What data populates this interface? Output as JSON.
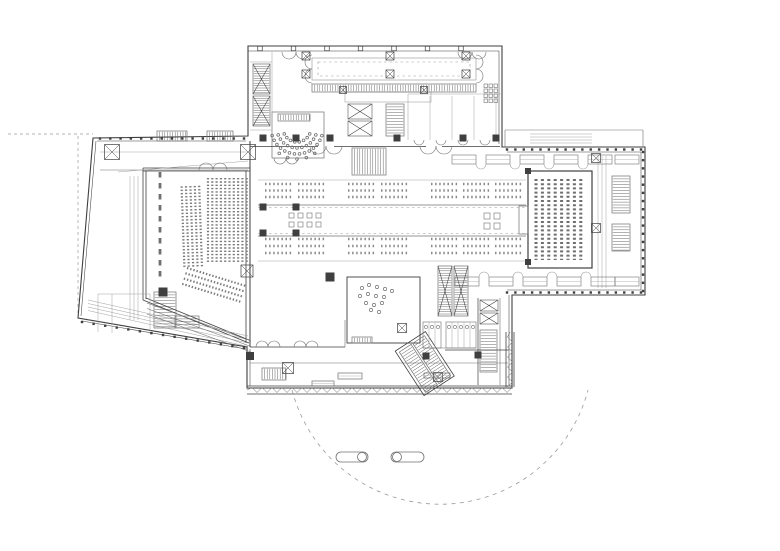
{
  "meta": {
    "title": "architectural-floor-plan",
    "description": "line-drawing building plan: auditorium, amphitheater, foyer with reading tables, book-stack hall, service cores, entrance plaza circle",
    "paper": "#ffffff"
  },
  "colors": {
    "ink": "#3f3f3f",
    "mid": "#707070",
    "light": "#a2a2a2",
    "hatch": "#565656",
    "dash": "#9a9a9a",
    "table": "#8b8b8b"
  },
  "rooms": [
    "auditorium",
    "amphitheater",
    "foyer-reading-tables",
    "book-stack-hall",
    "stair-cores",
    "escalators",
    "elevators",
    "restrooms",
    "shop-room",
    "south-gallery",
    "entrance-plaza"
  ],
  "gen": {
    "tables": {
      "bands": [
        {
          "rows": [
            184,
            190.5,
            197
          ]
        },
        {
          "rows": [
            239,
            246,
            253
          ]
        }
      ],
      "groups": [
        [
          265,
          293
        ],
        [
          298,
          326
        ],
        [
          348,
          376
        ],
        [
          381,
          409
        ],
        [
          431,
          459
        ],
        [
          463,
          491
        ],
        [
          495,
          523
        ]
      ],
      "dash": "1.5 2.6",
      "width": 2.4
    },
    "seatBlocks": [
      {
        "x0": 208,
        "step": 4.3,
        "count": 10,
        "y0": 178,
        "y1": 263,
        "tf": ""
      },
      {
        "x0": 183,
        "step": 4.4,
        "count": 5,
        "y0": 186,
        "y1": 268,
        "tf": "rotate(-2 193 227)"
      }
    ],
    "slantSeats": {
      "x": 187,
      "y": 268,
      "rows": 4,
      "gap": 5.3,
      "len": 62,
      "angle": 17
    },
    "stacks": {
      "x0": 536,
      "step": 6.4,
      "count": 8,
      "y0": 179,
      "y1": 260,
      "w": 3,
      "dash": "2 2.2"
    },
    "fan": {
      "cx": 297,
      "cy": 128,
      "rings": [
        {
          "r": 14,
          "a0": 25,
          "a1": 155,
          "n": 8
        },
        {
          "r": 20,
          "a0": 20,
          "a1": 160,
          "n": 11
        },
        {
          "r": 26,
          "a0": 17,
          "a1": 163,
          "n": 14
        },
        {
          "r": 31,
          "a0": 55,
          "a1": 125,
          "n": 5
        }
      ]
    },
    "mullions": [
      {
        "x1": 507,
        "y1": 149.5,
        "x2": 641,
        "y2": 149.5,
        "sp": 8
      },
      {
        "x1": 643,
        "y1": 152,
        "x2": 643,
        "y2": 291,
        "sp": 8
      },
      {
        "x1": 507,
        "y1": 292.5,
        "x2": 641,
        "y2": 292.5,
        "sp": 8
      },
      {
        "x1": 100,
        "y1": 138.5,
        "x2": 244,
        "y2": 138.5,
        "sp": 10
      },
      {
        "x1": 82,
        "y1": 322,
        "x2": 244,
        "y2": 348,
        "sp": 11
      }
    ],
    "topTicks": {
      "y": 48.5,
      "x0": 260,
      "x1": 494,
      "sp": 33.5,
      "s": 4.5
    },
    "zigzags": [
      {
        "x1": 247,
        "y1": 390,
        "x2": 512,
        "y2": 390,
        "amp": 2.5,
        "per": 5,
        "o": "h"
      },
      {
        "x1": 510,
        "y1": 332,
        "x2": 510,
        "y2": 387,
        "amp": 2.5,
        "per": 5,
        "o": "v"
      }
    ],
    "hatches": [
      [
        253,
        64,
        17,
        30,
        "esc"
      ],
      [
        253,
        96,
        17,
        30,
        "esc"
      ],
      [
        278,
        114,
        32,
        7,
        "v"
      ],
      [
        157,
        131,
        30,
        10,
        "v"
      ],
      [
        207,
        131,
        26,
        10,
        "v"
      ],
      [
        312,
        84,
        164,
        8,
        "v"
      ],
      [
        348,
        104,
        24,
        15,
        "x"
      ],
      [
        348,
        121,
        24,
        15,
        "x"
      ],
      [
        386,
        104,
        18,
        32,
        "h"
      ],
      [
        352,
        148,
        34,
        27,
        "v"
      ],
      [
        438,
        266,
        14,
        50,
        "esc"
      ],
      [
        454,
        266,
        14,
        50,
        "esc"
      ],
      [
        612,
        176,
        18,
        37,
        "h"
      ],
      [
        612,
        224,
        18,
        27,
        "h"
      ],
      [
        480,
        330,
        17,
        42,
        "h"
      ],
      [
        480,
        300,
        18,
        11,
        "x"
      ],
      [
        480,
        313,
        18,
        11,
        "x"
      ],
      [
        154,
        292,
        22,
        36,
        "h"
      ],
      [
        262,
        368,
        24,
        12,
        "v"
      ],
      [
        352,
        337,
        20,
        6,
        "v"
      ],
      [
        175,
        316,
        24,
        12,
        "h"
      ]
    ],
    "rotHatch": {
      "tf": "rotate(-33 425 364)",
      "outline": [
        407,
        337,
        36,
        53
      ],
      "rects": [
        [
          410,
          340,
          14,
          48
        ],
        [
          426,
          340,
          14,
          48
        ]
      ]
    },
    "restrooms": [
      {
        "x": 423,
        "y": 322,
        "w": 18,
        "h": 26,
        "n": 3
      },
      {
        "x": 446,
        "y": 322,
        "w": 30,
        "h": 26,
        "n": 5
      }
    ],
    "casework": [
      {
        "y": 155,
        "h": 9,
        "w": 24,
        "xs": [
          452,
          486,
          520,
          554,
          588,
          615
        ],
        "bulge": "down"
      },
      {
        "y": 277,
        "h": 9,
        "w": 24,
        "xs": [
          455,
          489,
          523,
          557,
          591,
          615
        ],
        "bulge": "up"
      }
    ],
    "doors": [
      [
        289,
        52,
        7,
        0
      ],
      [
        303,
        52,
        7,
        0
      ],
      [
        465,
        52,
        7,
        0
      ],
      [
        479,
        52,
        7,
        0
      ],
      [
        318,
        146,
        8,
        0
      ],
      [
        334,
        146,
        8,
        0
      ],
      [
        428,
        146,
        8,
        0
      ],
      [
        444,
        146,
        8,
        0
      ],
      [
        206,
        170,
        7,
        1
      ],
      [
        220,
        170,
        7,
        1
      ],
      [
        280,
        158,
        6,
        0
      ],
      [
        292,
        158,
        6,
        0
      ],
      [
        262,
        347,
        6,
        1
      ],
      [
        274,
        347,
        6,
        1
      ],
      [
        300,
        347,
        6,
        1
      ],
      [
        312,
        347,
        6,
        1
      ],
      [
        419,
        140,
        5,
        0
      ],
      [
        441,
        140,
        5,
        0
      ],
      [
        463,
        140,
        5,
        0
      ],
      [
        485,
        140,
        5,
        0
      ]
    ],
    "vdoors": [
      [
        312,
        62,
        7,
        0
      ],
      [
        312,
        76,
        7,
        0
      ],
      [
        476,
        62,
        7,
        1
      ],
      [
        476,
        76,
        7,
        1
      ]
    ],
    "columns": [
      [
        263,
        138,
        7
      ],
      [
        296,
        138,
        7
      ],
      [
        330,
        138,
        7
      ],
      [
        397,
        138,
        7
      ],
      [
        463,
        138,
        7
      ],
      [
        496,
        138,
        7
      ],
      [
        263,
        207,
        7
      ],
      [
        296,
        207,
        7
      ],
      [
        263,
        233,
        7
      ],
      [
        296,
        233,
        7
      ],
      [
        330,
        277,
        9
      ],
      [
        250,
        356,
        8
      ],
      [
        426,
        356,
        7
      ],
      [
        478,
        355,
        7
      ],
      [
        163,
        292,
        9
      ],
      [
        528,
        171,
        6
      ],
      [
        528,
        262,
        6
      ]
    ],
    "xsquares": [
      [
        112,
        152,
        15
      ],
      [
        248,
        152,
        15
      ],
      [
        247,
        271,
        12
      ],
      [
        288,
        368,
        11
      ],
      [
        306,
        56,
        8
      ],
      [
        390,
        56,
        8
      ],
      [
        466,
        56,
        8
      ],
      [
        306,
        74,
        8
      ],
      [
        390,
        74,
        8
      ],
      [
        466,
        74,
        8
      ],
      [
        343,
        90,
        7
      ],
      [
        424,
        90,
        7
      ],
      [
        402,
        328,
        9
      ],
      [
        438,
        377,
        9
      ],
      [
        596,
        158,
        9
      ],
      [
        596,
        228,
        9
      ]
    ],
    "sqClusters": [
      {
        "x": 289,
        "y": 213,
        "cols": 4,
        "rows": 2,
        "s": 5,
        "gap": 9
      },
      {
        "x": 484,
        "y": 213,
        "cols": 2,
        "rows": 2,
        "s": 6,
        "gap": 10
      }
    ],
    "grids": [
      {
        "x": 484,
        "y": 84,
        "cols": 3,
        "rows": 4,
        "s": 3.5,
        "gap": 1.5
      }
    ],
    "shopDots": [
      [
        362,
        288
      ],
      [
        369,
        285
      ],
      [
        377,
        287
      ],
      [
        385,
        289
      ],
      [
        392,
        291
      ],
      [
        360,
        296
      ],
      [
        368,
        294
      ],
      [
        376,
        296
      ],
      [
        384,
        297
      ],
      [
        366,
        303
      ],
      [
        374,
        305
      ],
      [
        382,
        303
      ],
      [
        371,
        310
      ],
      [
        379,
        312
      ]
    ],
    "benches": [
      [
        312,
        381,
        22,
        5
      ],
      [
        338,
        373,
        24,
        6
      ],
      [
        424,
        373,
        26,
        5
      ]
    ],
    "pills": [
      {
        "x": 336,
        "y": 452,
        "w": 32,
        "h": 10,
        "dot": "r"
      },
      {
        "x": 391,
        "y": 452,
        "w": 33,
        "h": 10,
        "dot": "l"
      }
    ],
    "plazaArc": {
      "d": "M292,390 A153,153 0 0 0 588,390",
      "dash": "4 4.5"
    },
    "dashLines": [
      [
        8,
        134,
        93,
        134
      ],
      [
        78,
        136,
        78,
        318
      ],
      [
        126,
        191,
        180,
        184
      ],
      [
        258,
        207.5,
        526,
        207.5
      ],
      [
        258,
        233.5,
        526,
        233.5
      ]
    ],
    "dashRects": [
      [
        318,
        62,
        152,
        14
      ]
    ],
    "dashSpecial": [
      {
        "x1": 160,
        "y1": 172,
        "x2": 160,
        "y2": 282,
        "w": 2.8,
        "dash": "5.5 5.5"
      }
    ],
    "solidLines": [
      [
        258,
        180,
        526,
        180,
        0.5,
        "light"
      ],
      [
        258,
        205,
        526,
        205,
        0.65,
        "mid"
      ],
      [
        258,
        236,
        526,
        236,
        0.65,
        "mid"
      ],
      [
        258,
        261,
        526,
        261,
        0.5,
        "light"
      ],
      [
        250,
        146.5,
        318,
        146.5,
        0.8,
        "ink"
      ],
      [
        334,
        146.5,
        426,
        146.5,
        0.8,
        "ink"
      ],
      [
        442,
        146.5,
        500,
        146.5,
        0.8,
        "ink"
      ],
      [
        272,
        52,
        272,
        133,
        0.55,
        "light"
      ],
      [
        250,
        62,
        272,
        62,
        0.55,
        "light"
      ],
      [
        250,
        130,
        272,
        130,
        0.55,
        "light"
      ],
      [
        408,
        94,
        502,
        94,
        0.55,
        "light"
      ],
      [
        408,
        94,
        408,
        140,
        0.55,
        "light"
      ],
      [
        430,
        96,
        430,
        140,
        0.5,
        "light"
      ],
      [
        452,
        96,
        452,
        140,
        0.5,
        "light"
      ],
      [
        474,
        96,
        474,
        140,
        0.5,
        "light"
      ],
      [
        496,
        96,
        496,
        140,
        0.5,
        "light"
      ],
      [
        100,
        152,
        248,
        152,
        0.5,
        "light"
      ],
      [
        100,
        170,
        248,
        170,
        0.6,
        "mid"
      ],
      [
        118,
        172,
        248,
        161,
        0.5,
        "light"
      ],
      [
        130,
        176,
        130,
        320,
        0.5,
        "light"
      ],
      [
        134,
        176,
        134,
        320,
        0.5,
        "light"
      ],
      [
        138,
        176,
        138,
        320,
        0.5,
        "light"
      ],
      [
        598,
        156,
        598,
        288,
        0.5,
        "light"
      ],
      [
        602,
        156,
        602,
        288,
        0.5,
        "light"
      ],
      [
        606,
        156,
        606,
        288,
        0.5,
        "light"
      ],
      [
        505,
        130,
        643,
        130,
        0.6,
        "mid"
      ],
      [
        505,
        130,
        505,
        147,
        0.6,
        "mid"
      ],
      [
        643,
        130,
        643,
        147,
        0.6,
        "mid"
      ],
      [
        478,
        298,
        478,
        385,
        0.7,
        "ink"
      ],
      [
        500,
        298,
        500,
        385,
        0.6,
        "mid"
      ],
      [
        250,
        347,
        345,
        347,
        0.75,
        "ink"
      ],
      [
        445,
        350,
        509,
        350,
        0.75,
        "ink"
      ],
      [
        250,
        363,
        508,
        363,
        0.6,
        "mid"
      ],
      [
        98,
        294,
        150,
        294,
        0.5,
        "light"
      ],
      [
        98,
        294,
        98,
        332,
        0.5,
        "light"
      ],
      [
        150,
        294,
        150,
        334,
        0.5,
        "light"
      ],
      [
        112,
        294,
        112,
        333,
        0.5,
        "light"
      ],
      [
        345,
        320,
        345,
        347,
        0.6,
        "mid"
      ],
      [
        423,
        348,
        476,
        348,
        0.6,
        "mid"
      ]
    ],
    "parallels": [
      {
        "x1": 88,
        "y1": 300,
        "x2": 248,
        "y2": 336,
        "n": 4,
        "dx": 0,
        "dy": 3.5,
        "w": 0.55,
        "c": "light"
      },
      {
        "x1": 147,
        "y1": 303,
        "x2": 251,
        "y2": 341,
        "n": 3,
        "dx": 0,
        "dy": 5.5,
        "w": 0.6,
        "c": "mid"
      },
      {
        "x1": 530,
        "y1": 134,
        "x2": 592,
        "y2": 134,
        "n": 4,
        "dx": 0,
        "dy": 3,
        "w": 0.5,
        "c": "light"
      }
    ]
  }
}
